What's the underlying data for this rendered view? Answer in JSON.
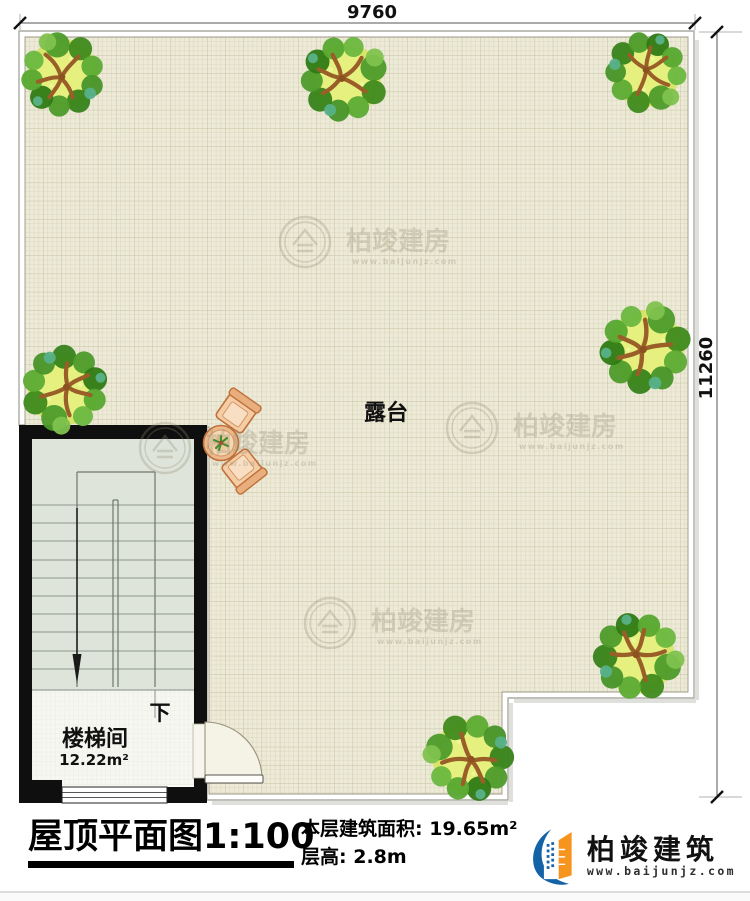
{
  "plan": {
    "dim_width": "9760",
    "dim_height": "11260",
    "terrace_label": "露台",
    "stair_room_label": "楼梯间",
    "stair_room_area": "12.22m²",
    "stair_direction": "下"
  },
  "watermark": {
    "text": "柏竣建房",
    "url": "www.baijunjz.com"
  },
  "title_block": {
    "drawing_title": "屋顶平面图",
    "scale": "1:100",
    "area_label": "本层建筑面积:",
    "area_value": "19.65m²",
    "height_label": "层高:",
    "height_value": "2.8m"
  },
  "brand": {
    "name": "柏竣建筑",
    "website": "www.baijunjz.com",
    "colors": {
      "blue": "#1563A7",
      "orange": "#F7941E"
    }
  },
  "palette": {
    "terrace_bg": "#EDEAD8",
    "grid_minor": "#DCD8BE",
    "grid_major": "#C7C2A1",
    "wall_black": "#0f0f0f",
    "stairs_fill": "#DFE4DA",
    "stair_floor": "#F7F7F2",
    "tree_green": "#4D9B2B",
    "furniture_tan": "#E9B98B"
  }
}
